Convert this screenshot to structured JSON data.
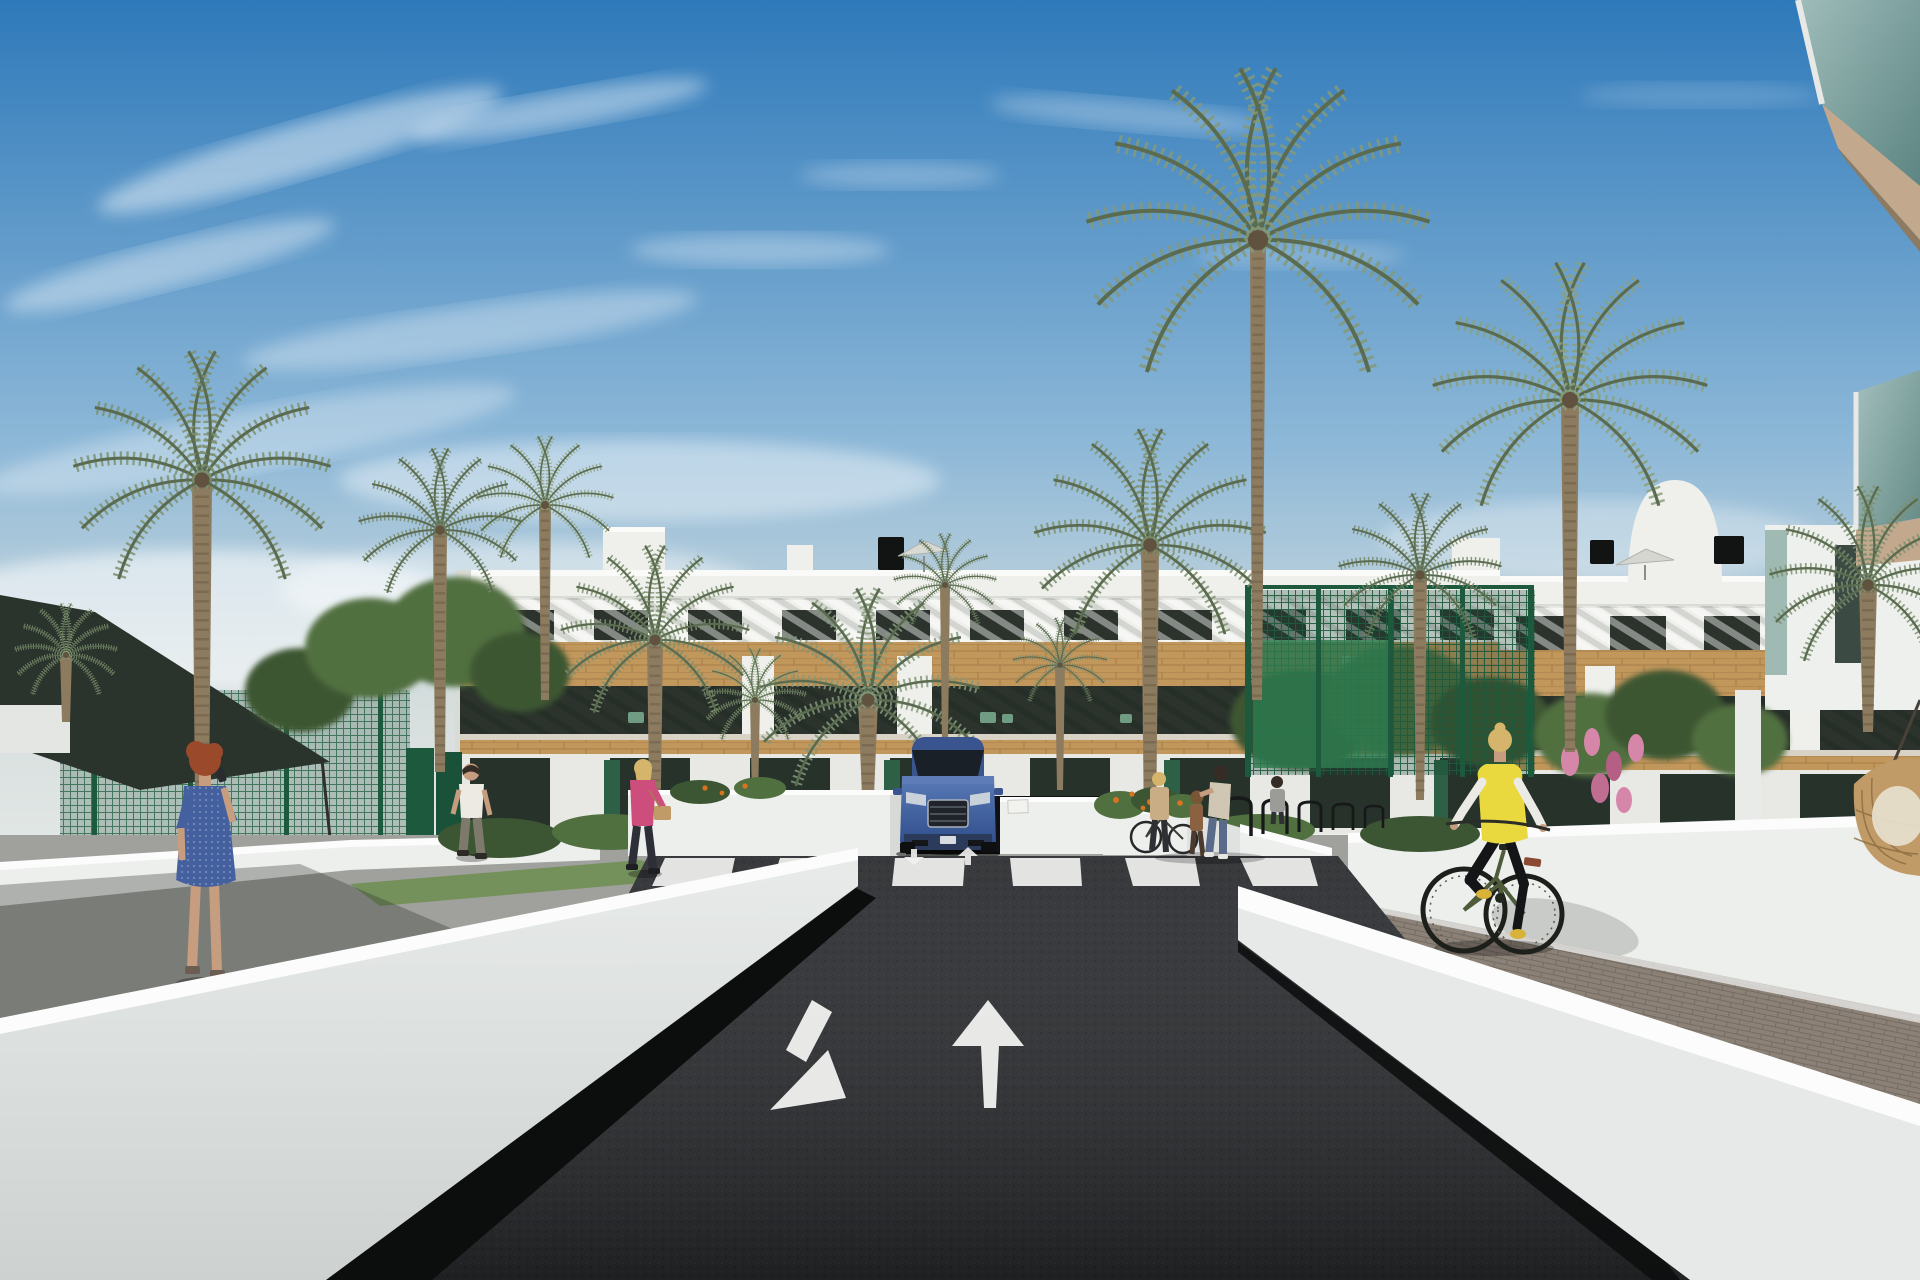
{
  "scene": {
    "kind": "3d-architectural-exterior-render",
    "description": "Street-level 3D visualization of a new white Mediterranean apartment complex with wood-clad balconies and rooftop terraces, lined with tall date palms. A dark two-way asphalt road with painted white arrows (one pointing toward the viewer, one pointing away) leads to a zebra crossing where a blue SUV emerges from a basement garage ramp between low white walls. A red-haired woman in a blue dress stands on the left walkway taking a picture, a man in a white t-shirt and a blonde woman in a pink jacket walk garden paths, a family group stands near black bike racks on the right sidewalk, and a cyclist in a yellow hi-vis vest rides a paved lane beside a white wall under a hanging wicker chair. Green mesh fences, shrubs with orange and pink flowers, roof parasols and a dark shade sail complete the scene. No text is visible in the image.",
    "visible_text": []
  },
  "palette": {
    "sky_top": "#2e79ba",
    "sky_mid": "#8fb9d8",
    "sky_haze": "#d6dedd",
    "building_white": "#eff0ec",
    "building_shade": "#d9dbd5",
    "window_glass": "#2b332c",
    "wood": "#c2975c",
    "wood_dark": "#8f6a3c",
    "fence_green": "#1d5a3d",
    "fence_glass": "#2e7b4f",
    "foliage": "#51703f",
    "foliage_dark": "#3c5633",
    "foliage_light": "#7c9a64",
    "palm_green": "#7d9070",
    "palm_dark": "#5a6b4f",
    "trunk": "#8d7b5f",
    "trunk_dark": "#60523f",
    "road": "#282a2d",
    "marking": "#f2f3f1",
    "wall_white": "#edefed",
    "wall_bright": "#fbfcfb",
    "wall_shade": "#c9cecc",
    "shadow": "#0c0d0d",
    "pavement": "#a0a19c",
    "cobble": "#8b8177",
    "cobble_line": "#6e665e",
    "car_blue": "#44639f",
    "car_blue_dark": "#2b4577",
    "glass_teal": "#86a8a0",
    "soffit": "#c2a88c",
    "vest_yellow": "#e9d83e",
    "jacket_pink": "#cd4e7c",
    "dress_blue": "#45609f",
    "skin": "#c79d80",
    "hair_red": "#9a4a2b",
    "hair_blonde": "#d5b56c",
    "hair_dark": "#352c25",
    "bag_tan": "#c09a67",
    "flower_orange": "#d8741f",
    "flower_pink": "#d687a9",
    "bike_frame": "#4e5c3b",
    "canopy": "#2a332c",
    "shirt_white": "#eceae3",
    "pants_gray": "#7d7a6b",
    "jeans": "#5a6b8a"
  },
  "objects": {
    "buildings": [
      "three-storey white apartment block with louvred top floor and wood-clad balcony band",
      "closer right wing with rooftop stair dome",
      "near foreground balcony corner with teal glass railing"
    ],
    "road_markings": [
      "zebra crossing of six white stripes",
      "large down-left arrow (lane toward viewer)",
      "large up arrow (lane away from viewer)",
      "two small arrows at the garage ramp"
    ],
    "vehicle": "blue SUV front view at garage ramp",
    "people": [
      "woman in blue dress with red hair taking photo",
      "man in white t-shirt walking away",
      "blonde woman in pink jacket with tan handbag",
      "woman standing with bicycle",
      "woman leaning to a child",
      "child in brown",
      "woman in gray top",
      "cyclist in yellow safety vest on green bike"
    ],
    "vegetation": [
      "date palm trees",
      "fan palm",
      "leafy trees",
      "hedges",
      "shrubs with orange flowers",
      "shrubs with pink flowers"
    ],
    "street_furniture": [
      "black bike racks",
      "green mesh fence and gates",
      "dark shade sail",
      "roof parasols",
      "hanging wicker chair"
    ]
  }
}
